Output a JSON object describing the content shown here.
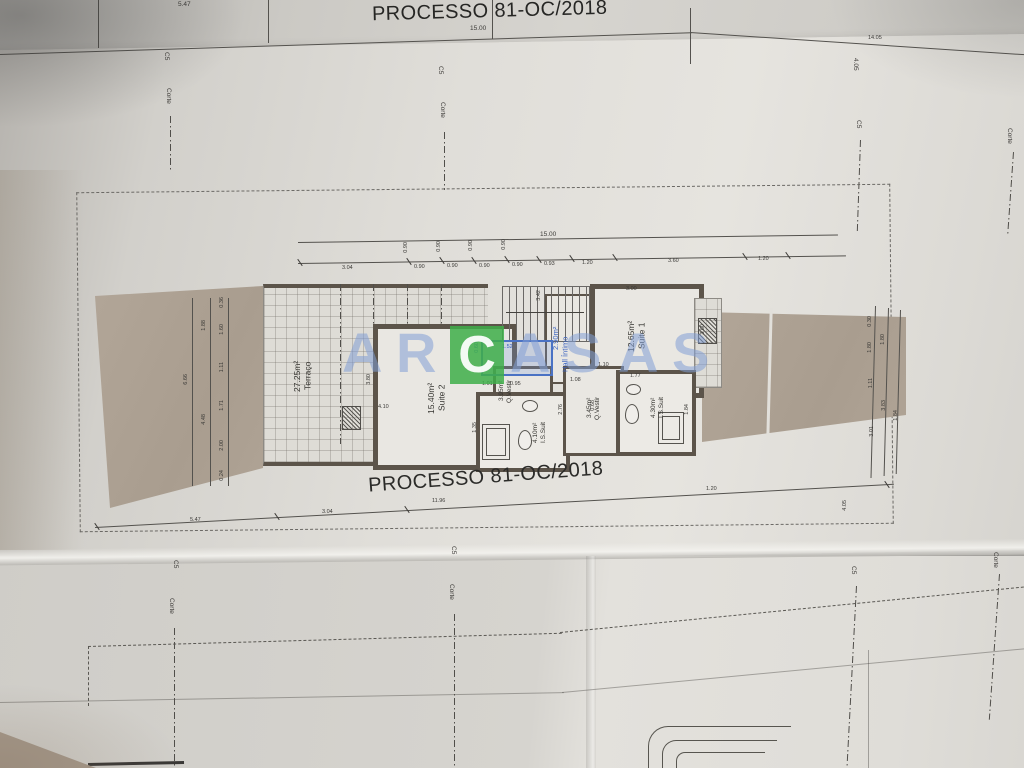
{
  "document": {
    "upper_sheet_title": "PROCESSO 81-OC/2018",
    "plan_title": "PROCESSO 81-OC/2018"
  },
  "watermark": {
    "letters": [
      "A",
      "R",
      "C",
      "A",
      "S",
      "A",
      "S"
    ],
    "green_hex": "#3eae49",
    "blue_hex": "#829ed6"
  },
  "section_marks": {
    "corte": "Corte",
    "c5": "C5"
  },
  "rooms": {
    "terraco": {
      "name": "Terraço",
      "area": "27.25m²"
    },
    "suite2": {
      "name": "Suite 2",
      "area": "15.40m²"
    },
    "hall": {
      "name": "Hall Íntimo",
      "area": "2.90m²"
    },
    "suite1": {
      "name": "Suite 1",
      "area": "12.65m²"
    },
    "qvestir2": {
      "name": "Q.Vestir",
      "area": "3.95m²"
    },
    "issuit2": {
      "name": "I.S.Suit",
      "area": "4.10m²"
    },
    "qvestir1": {
      "name": "Q.Vestir",
      "area": "3.45m²"
    },
    "issuit1": {
      "name": "I.S.Suit",
      "area": "4.30m²"
    }
  },
  "dimensions": {
    "upper_sheet": {
      "left": "5.47",
      "total": "15.00",
      "right": "14.05",
      "side": "4.05"
    },
    "top_total": "15.00",
    "top_segments": [
      "3.04",
      "0.90",
      "0.90",
      "0.90",
      "0.90",
      "0.93",
      "1.20",
      "3.60",
      "1.20"
    ],
    "left_total": "6.66",
    "left_pair": [
      "1.88",
      "4.48"
    ],
    "left_segments": [
      "0.36",
      "1.60",
      "1.11",
      "1.71",
      "2.00",
      "0.24"
    ],
    "right_col1": [
      "0.30",
      "1.80",
      "1.11",
      "3.01"
    ],
    "right_col2": [
      "1.80",
      "3.83"
    ],
    "right_col3": [
      "1.84"
    ],
    "bottom_segments": [
      "5.47",
      "3.04",
      "11.96",
      "1.20"
    ],
    "bottom_side": "4.05",
    "inner": [
      "3.42",
      "3.00",
      "4.10",
      "3.80",
      "1.52",
      "0.60",
      "1.01",
      "0.95",
      "1.08",
      "1.77",
      "2.76",
      "1.84",
      "1.35",
      "3.60",
      "1.10",
      "0.68"
    ]
  }
}
